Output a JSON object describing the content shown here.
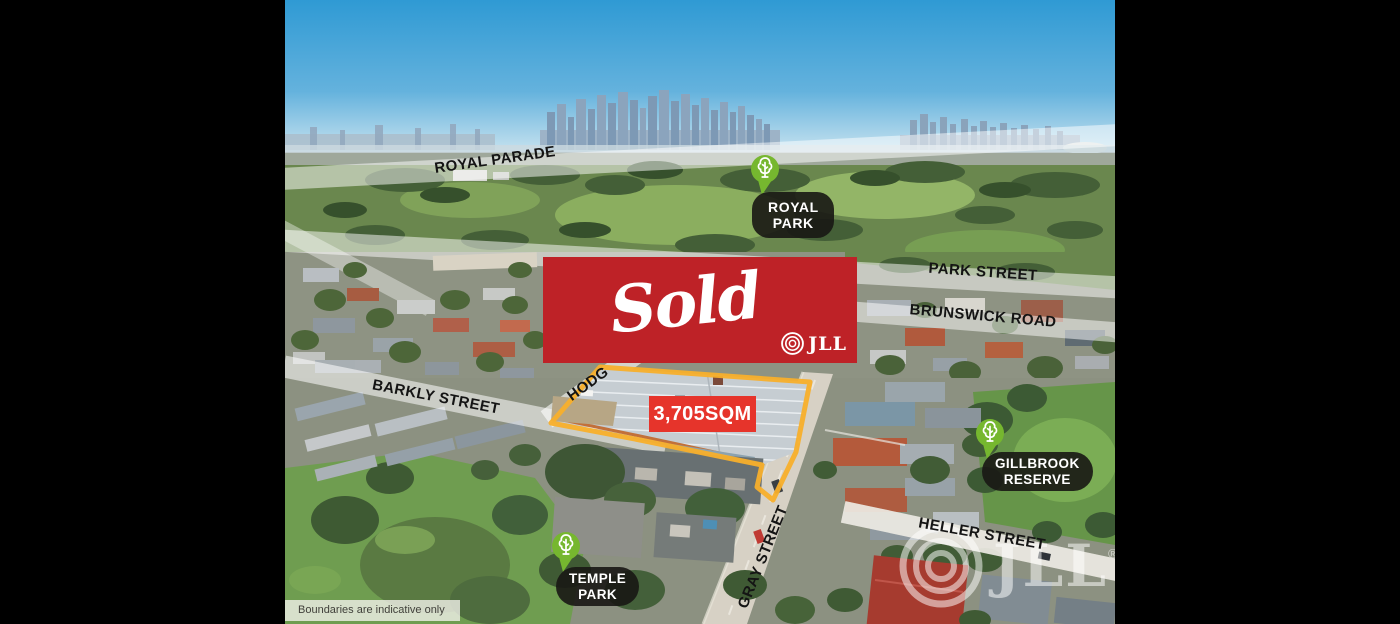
{
  "sold_banner": {
    "text": "Sold",
    "brand": "JLL",
    "bg": "#be2227"
  },
  "area_label": {
    "text": "3,705SQM",
    "bg": "#e6342b"
  },
  "streets": [
    {
      "label": "ROYAL PARADE"
    },
    {
      "label": "PARK STREET"
    },
    {
      "label": "BRUNSWICK ROAD"
    },
    {
      "label": "BARKLY STREET"
    },
    {
      "label": "HODG"
    },
    {
      "label": "GRAY STREET"
    },
    {
      "label": "HELLER STREET"
    }
  ],
  "parks": [
    {
      "line1": "ROYAL PARK",
      "line2": ""
    },
    {
      "line1": "GILLBROOK",
      "line2": "RESERVE"
    },
    {
      "line1": "TEMPLE",
      "line2": "PARK"
    }
  ],
  "footnote": {
    "text": "Boundaries are indicative only"
  },
  "watermark": {
    "brand": "JLL",
    "reg": "®"
  },
  "colors": {
    "banner_red": "#be2227",
    "area_red": "#e6342b",
    "boundary_yellow": "#f8af2b",
    "pin_green": "#76b72f",
    "pill_black": "#181714",
    "road_band_white": "rgba(255,255,255,0.55)"
  }
}
